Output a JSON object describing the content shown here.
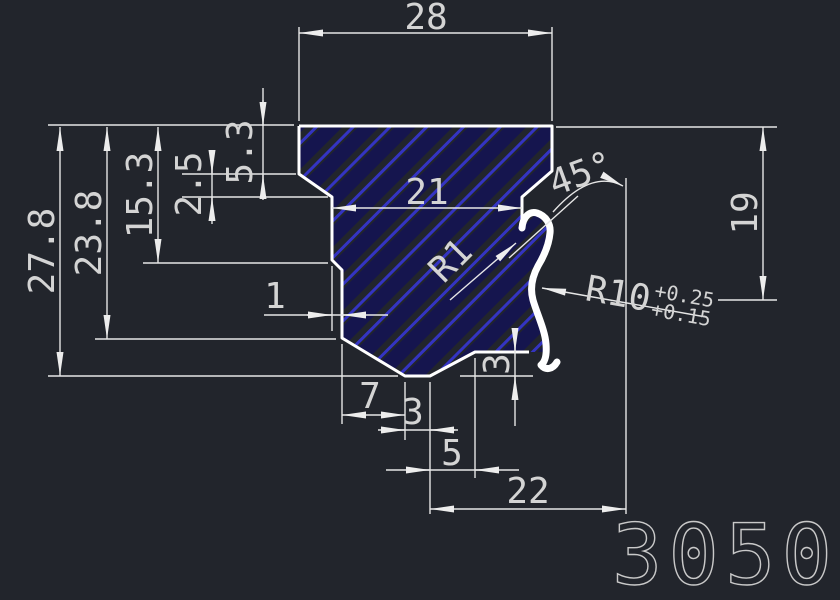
{
  "part_number": "3050",
  "colors": {
    "background": "#22252c",
    "outline": "#ffffff",
    "dim_line": "#e6e6e6",
    "dim_text": "#d4d4d4",
    "arrow": "#ededed",
    "hatch_bright": "#3434c2",
    "hatch_dark": "#15154e",
    "part_number_color": "#c9c9c9"
  },
  "dimensions": {
    "width_top": "28",
    "width_mid": "21",
    "height_total": "27.8",
    "height_to_chamfer": "23.8",
    "height_to_step": "15.3",
    "taper_height": "2.5",
    "crown_height": "5.3",
    "groove_depth": "19",
    "step_offset": "1",
    "bottom_seg_left": "7",
    "bottom_flat": "3",
    "bottom_chamfer": "5",
    "width_bottom": "22",
    "lip_step_height": "3",
    "chamfer_angle": "45°",
    "fillet_radius": "R1",
    "groove_radius": "R10",
    "radius_tol_upper": "+0.25",
    "radius_tol_lower": "+0.15"
  }
}
